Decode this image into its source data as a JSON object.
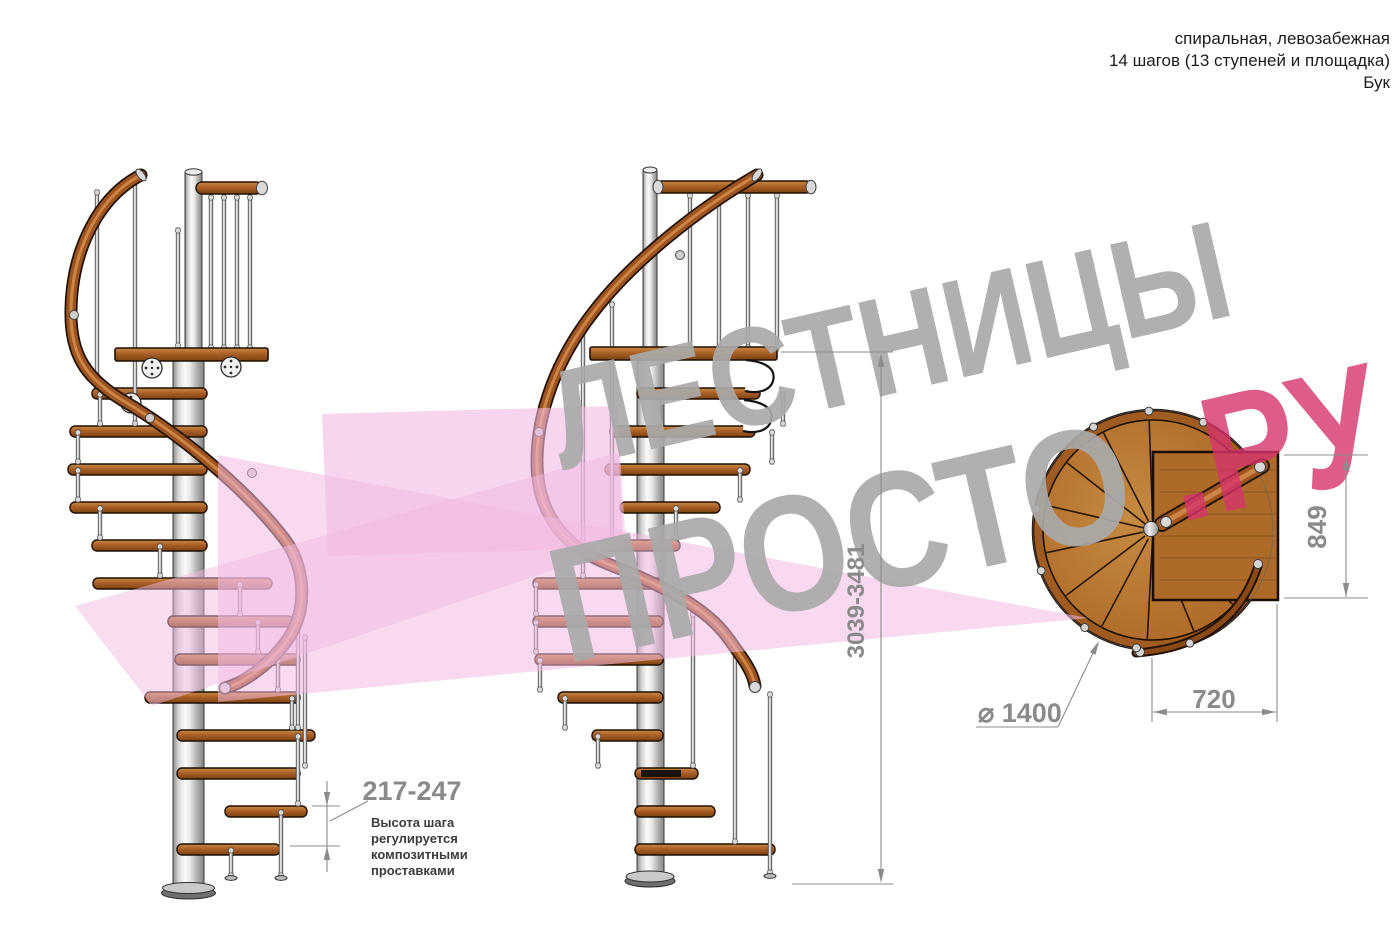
{
  "header": {
    "line1": "спиральная, левозабежная",
    "line2": "14 шагов (13 ступеней и площадка)",
    "line3": "Бук"
  },
  "watermark": {
    "line1": "ЛЕСТНИЦЫ",
    "line2_gray": "ПРОСТО",
    "line2_pink": ".РУ",
    "gray_color": "#a9a9a9",
    "pink_color": "#d6336c"
  },
  "dimensions": {
    "step_height": "217-247",
    "step_height_note": [
      "Высота шага",
      "регулируется",
      "композитными",
      "проставками"
    ],
    "total_height": "3039-3481",
    "landing_depth": "849",
    "landing_width": "720",
    "diameter": "⌀ 1400"
  },
  "colors": {
    "wood": "#a96428",
    "metal": "#cfcfcf",
    "dimension_gray": "#8a8a8a",
    "shape_pink": "#f2b9e2",
    "background": "#ffffff"
  }
}
